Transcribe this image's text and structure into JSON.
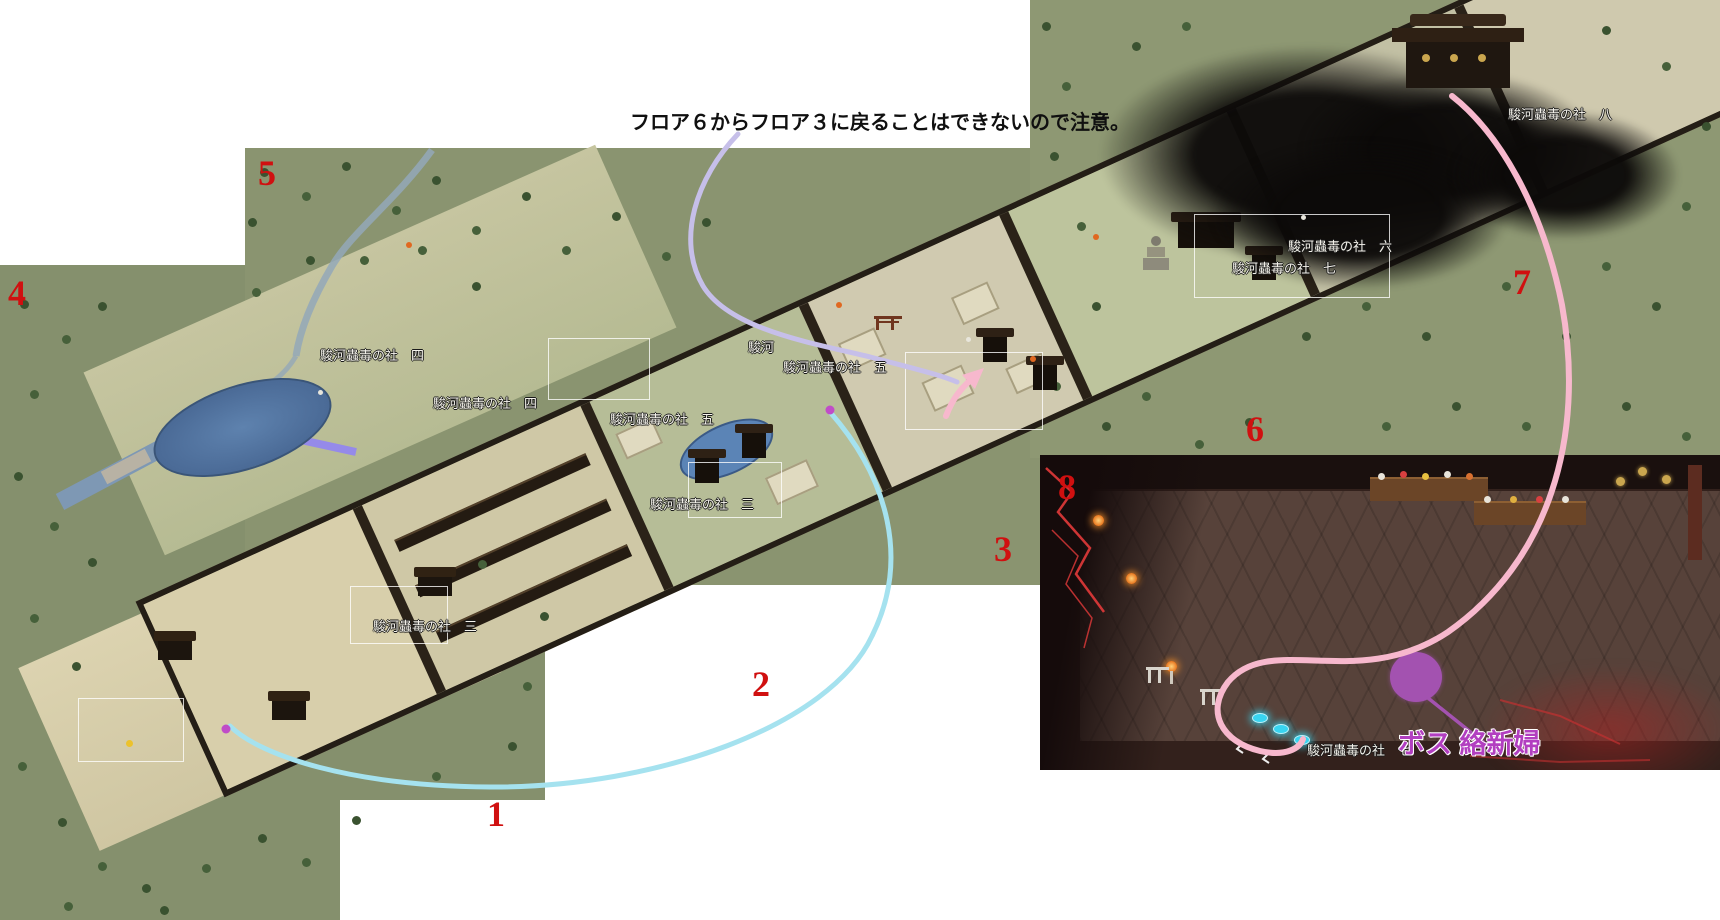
{
  "annotation": {
    "text": "フロア６からフロア３に戻ることはできないので注意。"
  },
  "boss": {
    "label": "ボス 絡新婦"
  },
  "floor_numbers": {
    "f1": "1",
    "f2": "2",
    "f3": "3",
    "f4": "4",
    "f5": "5",
    "f6": "6",
    "f7": "7",
    "f8": "8"
  },
  "map_labels": {
    "four_a": "駿河蟲毒の社　四",
    "four_b": "駿河蟲毒の社　四",
    "five_a": "駿河蟲毒の社　五",
    "five_partial": "駿河",
    "five_b": "駿河蟲毒の社　五",
    "three_a": "駿河蟲毒の社　三",
    "three_b": "駿河蟲毒の社　三",
    "six_a": "駿河蟲毒の社　六",
    "seven_a": "駿河蟲毒の社　七",
    "eight_a": "駿河蟲毒の社　八",
    "seven_inset": "駿河蟲毒の社　七"
  },
  "colors": {
    "floor_number": "#d01010",
    "boss_text": "#b23fc0",
    "route_pink": "#f7b8cd",
    "route_cyan": "#a5e2ef",
    "route_lavender": "#c6bfe9",
    "waypoint_magenta": "#c04cc8",
    "boss_point": "#a352b0",
    "entry_glow_cyan": "#38d4f0",
    "lightning_red": "#e23a3a",
    "stream_blue": "#93a8b8",
    "moat_blue": "#7e98b4",
    "canal_purple": "#958ae9"
  }
}
